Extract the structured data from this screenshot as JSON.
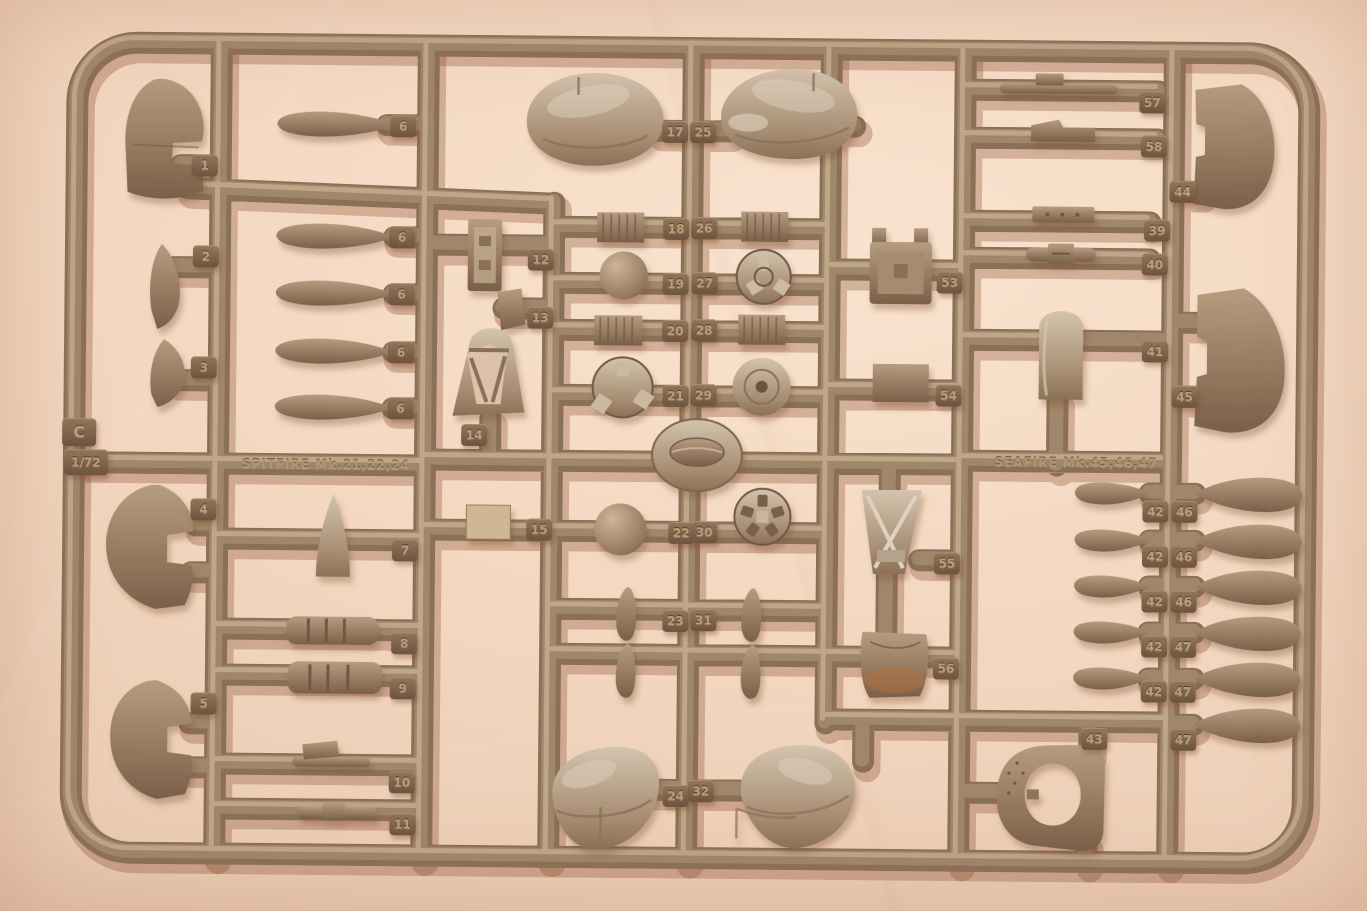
{
  "scene": {
    "type": "photograph",
    "subject": "Tan injection-molded plastic model kit sprue with numbered 1/72 aircraft parts on a pink backdrop",
    "frame_letter": "C",
    "scale_label": "1/72",
    "spitfire_bar_label": "SPITFIRE Mk.21,22,24",
    "seafire_bar_label": "SEAFIRE Mk.45,46,47"
  },
  "colors": {
    "backdrop": "#f3d7c0",
    "plastic_base": "#8b7058",
    "plastic_highlight": "#c6ae90",
    "plastic_shadow": "#6a523e",
    "tag_face": "#7c614a",
    "embossed_number": "#bb9d7c"
  },
  "tags": [
    "1",
    "2",
    "3",
    "4",
    "5",
    "6",
    "6",
    "6",
    "6",
    "6",
    "7",
    "8",
    "9",
    "10",
    "11",
    "12",
    "13",
    "14",
    "15",
    "17",
    "25",
    "18",
    "26",
    "19",
    "27",
    "20",
    "28",
    "21",
    "29",
    "22",
    "30",
    "23",
    "31",
    "24",
    "32",
    "53",
    "54",
    "55",
    "56",
    "57",
    "58",
    "44",
    "39",
    "40",
    "41",
    "45",
    "42",
    "46",
    "42",
    "46",
    "42",
    "46",
    "42",
    "47",
    "42",
    "47",
    "43",
    "47"
  ]
}
